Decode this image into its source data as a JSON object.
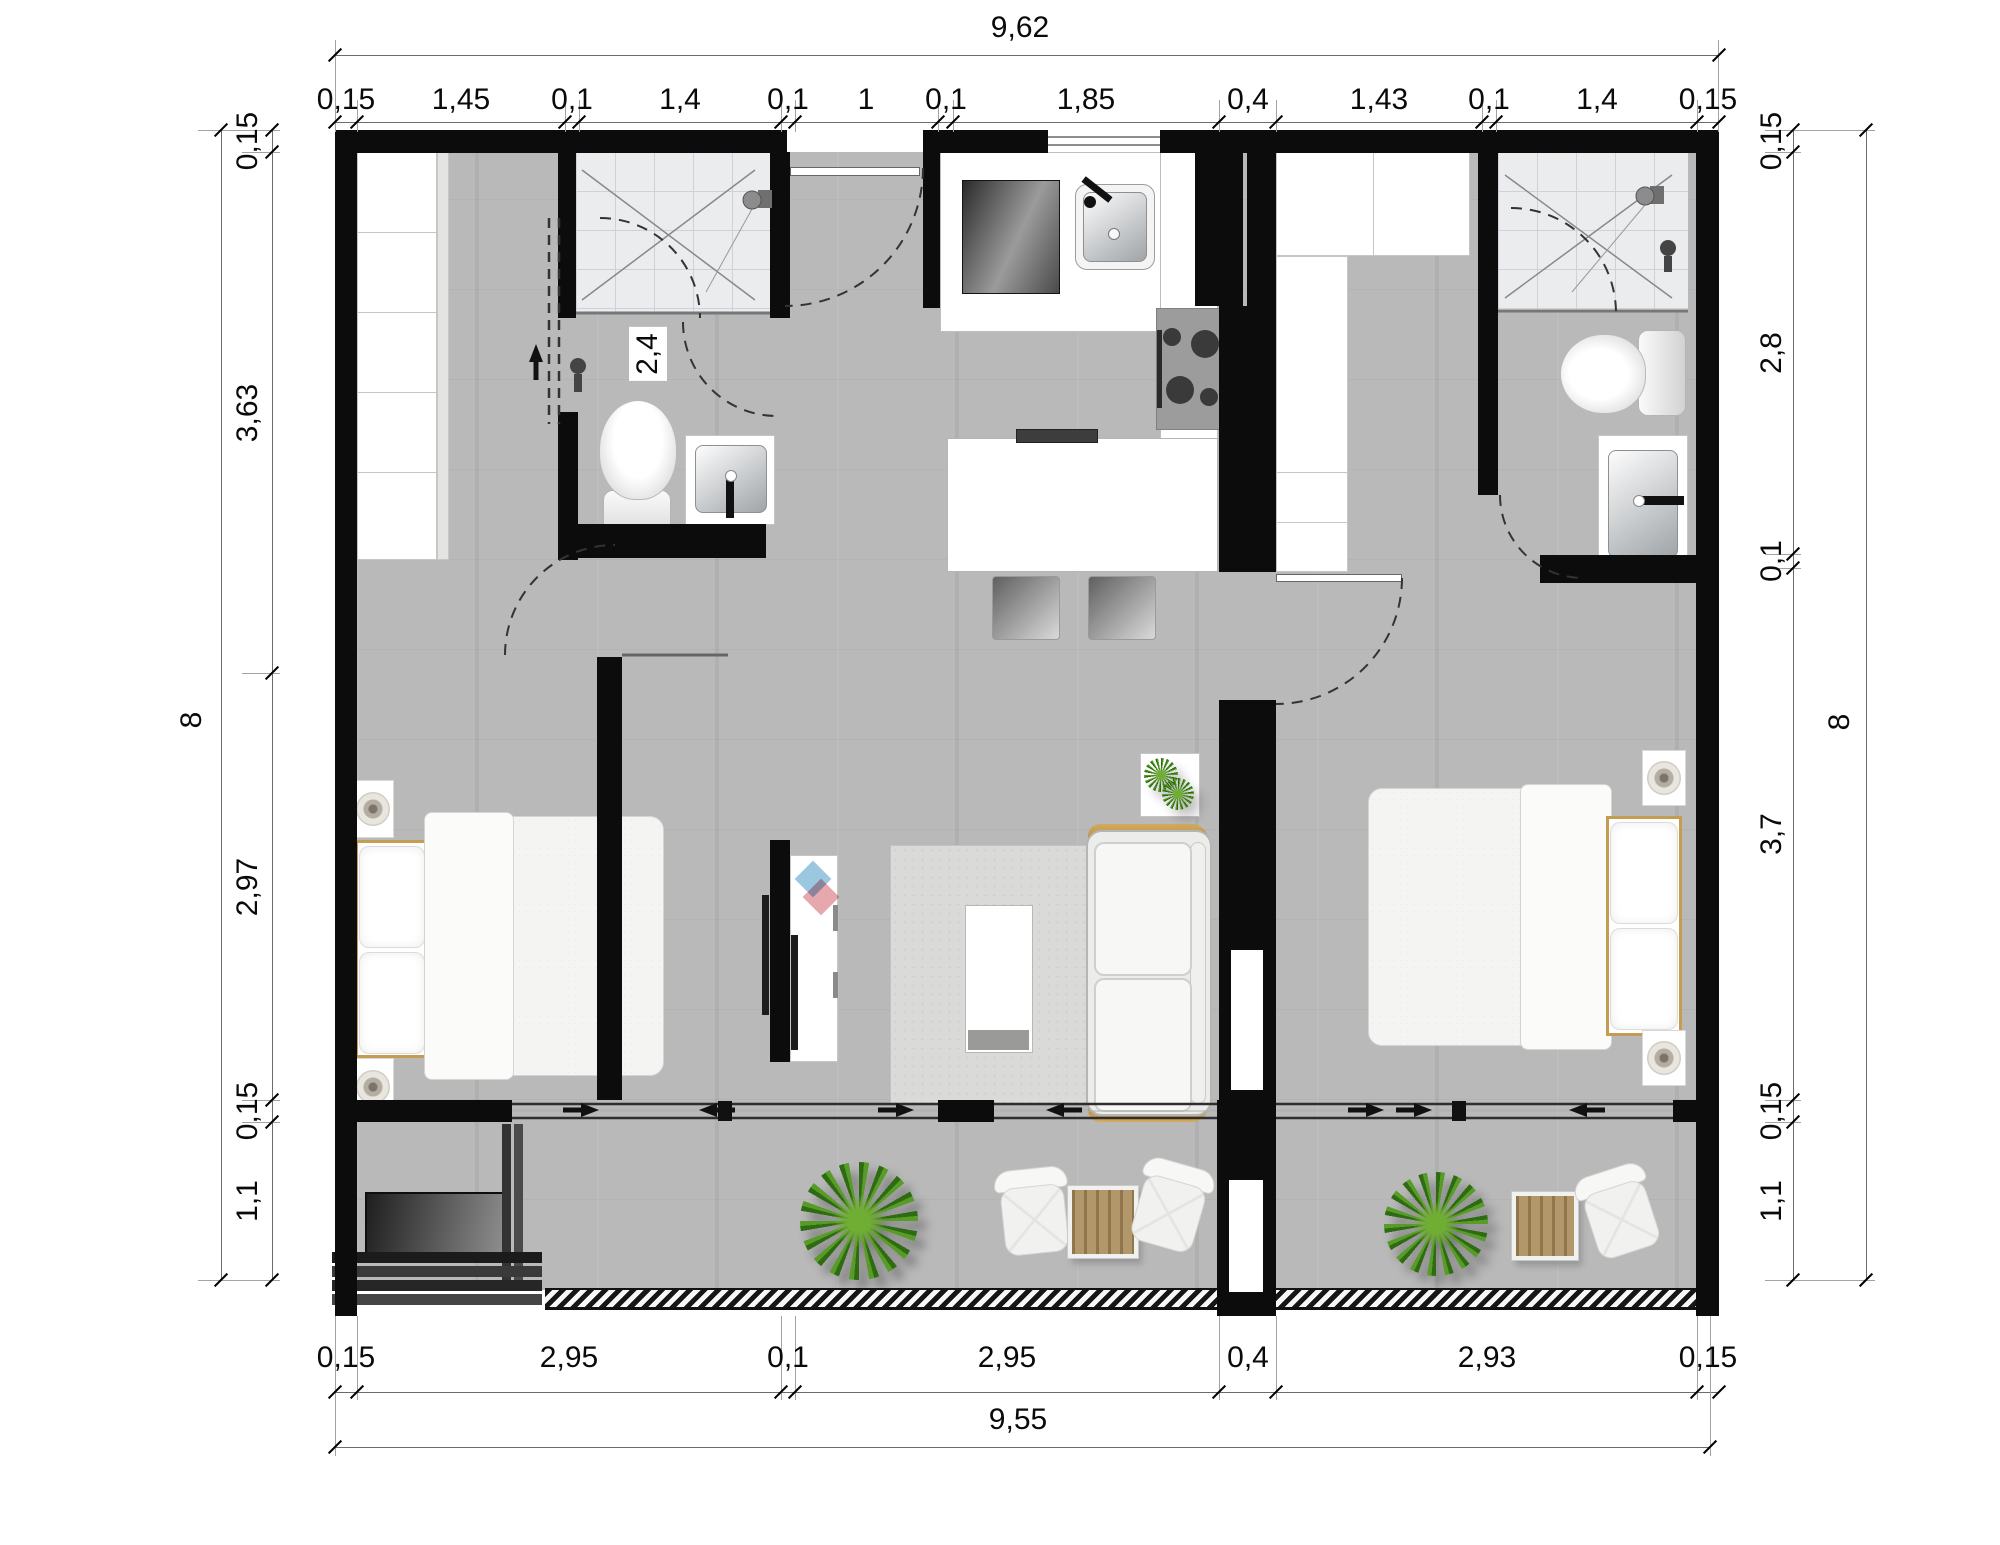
{
  "dimensions": {
    "top": {
      "total": "9,62",
      "segments": [
        "0,15",
        "1,45",
        "0,1",
        "1,4",
        "0,1",
        "1",
        "0,1",
        "1,85",
        "0,4",
        "1,43",
        "0,1",
        "1,4",
        "0,15"
      ]
    },
    "bottom": {
      "total": "9,55",
      "segments": [
        "0,15",
        "2,95",
        "0,1",
        "2,95",
        "0,4",
        "2,93",
        "0,15"
      ]
    },
    "left": {
      "total": "8",
      "segments": [
        "0,15",
        "3,63",
        "2,97",
        "0,15",
        "1,1"
      ]
    },
    "right": {
      "total": "8",
      "segments": [
        "0,15",
        "2,8",
        "0,1",
        "3,7",
        "0,15",
        "1,1"
      ]
    },
    "interior": {
      "bathroom_width": "2,4"
    }
  },
  "colors": {
    "wall": "#0c0c0c",
    "floor": "#b8b9b8",
    "tile": "#eaecee",
    "wood_accent": "#c59d52",
    "table_wood": "#b2976b",
    "plant_green": "#4a8a1f",
    "logo_blue": "#9cc7e0",
    "logo_red": "#e6a7ad"
  }
}
